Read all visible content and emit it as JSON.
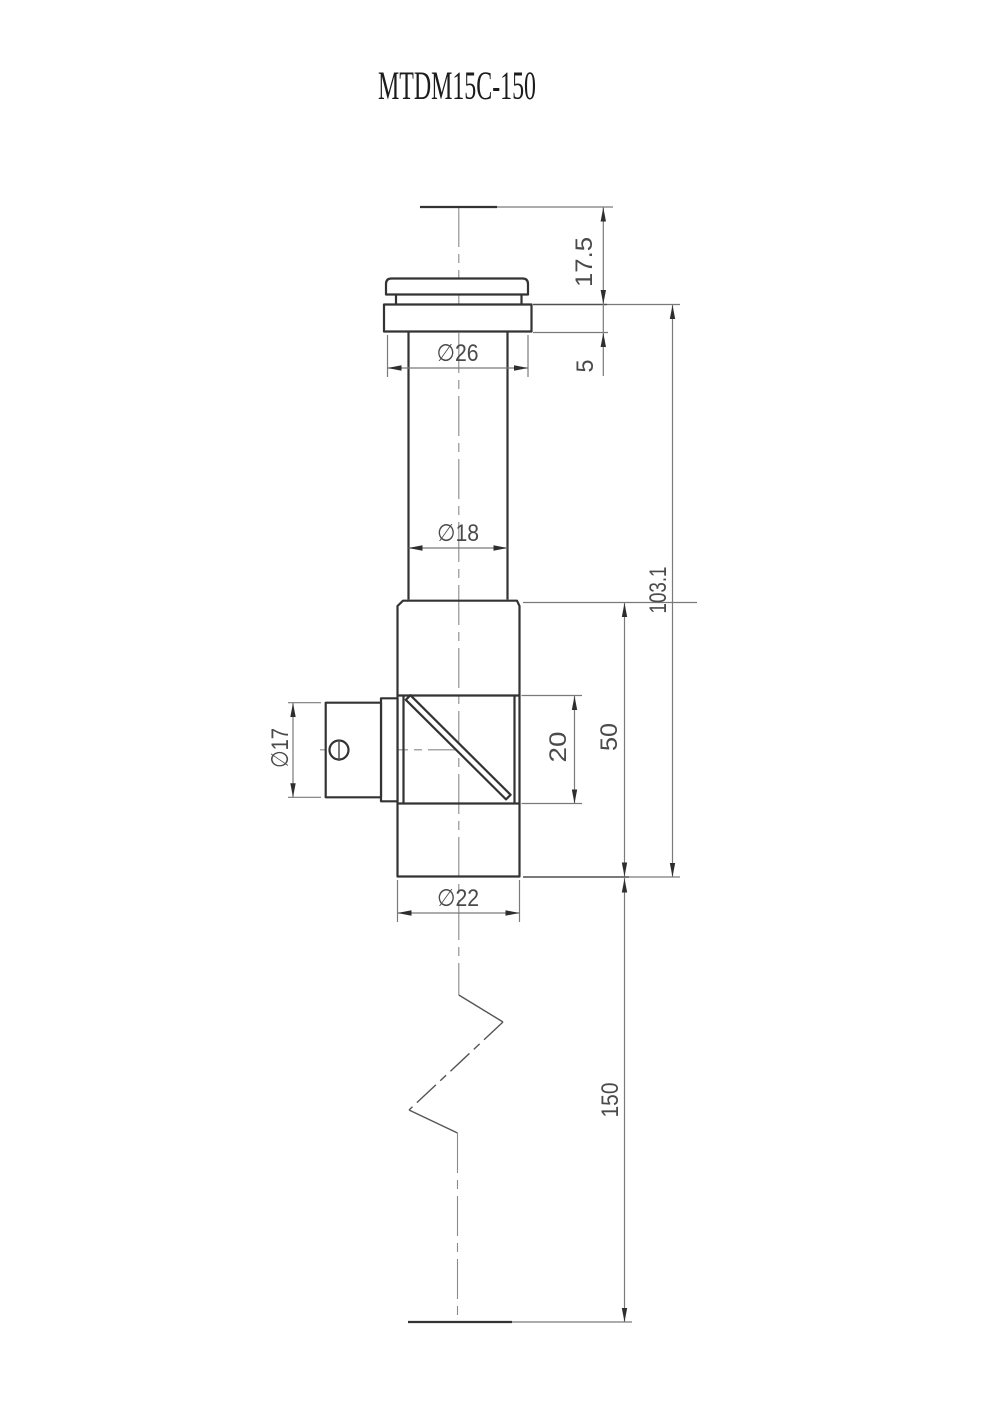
{
  "title": "MTDM15C-150",
  "dimensions": {
    "top_height": "17.5",
    "flange_thickness": "5",
    "flange_diameter": "∅26",
    "tube_diameter": "∅18",
    "upper_length": "103.1",
    "port_diameter": "∅17",
    "window_size": "20",
    "body_length": "50",
    "body_diameter": "∅22",
    "total_length": "150"
  }
}
